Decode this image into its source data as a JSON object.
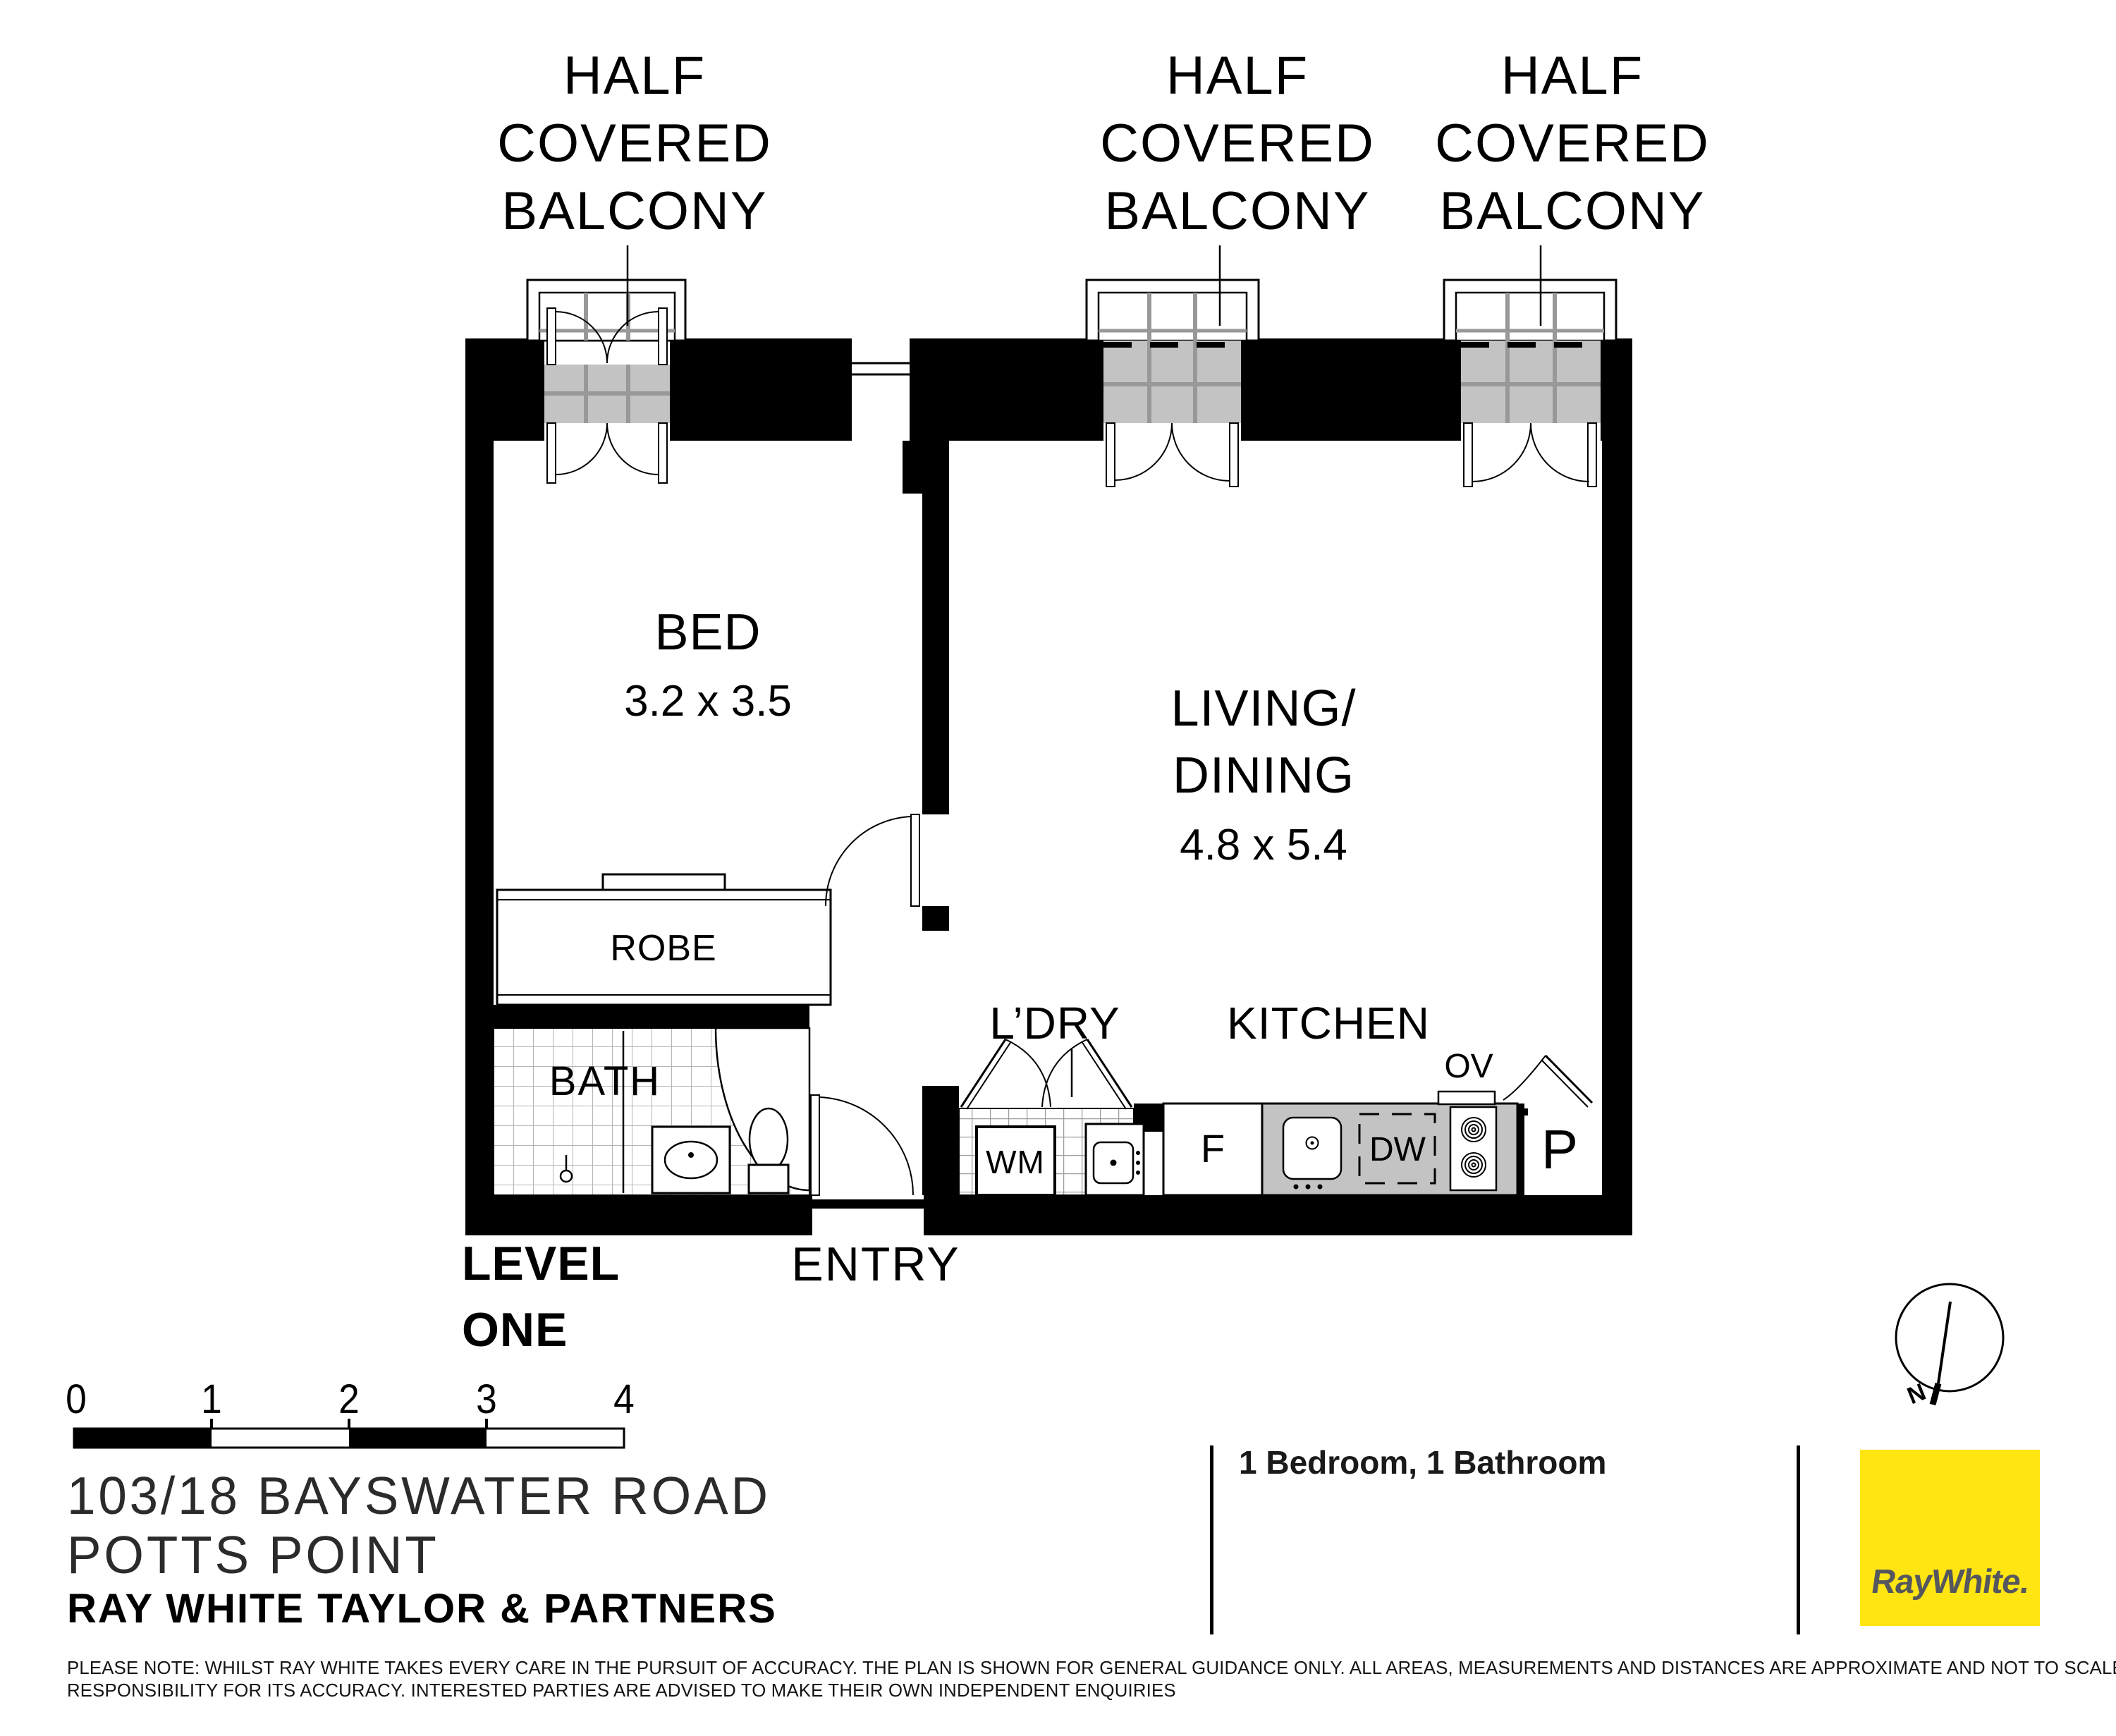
{
  "balcony_labels": [
    {
      "line1": "HALF",
      "line2": "COVERED",
      "line3": "BALCONY"
    },
    {
      "line1": "HALF",
      "line2": "COVERED",
      "line3": "BALCONY"
    },
    {
      "line1": "HALF",
      "line2": "COVERED",
      "line3": "BALCONY"
    }
  ],
  "rooms": {
    "bed": {
      "name": "BED",
      "dims": "3.2 x 3.5"
    },
    "living": {
      "line1": "LIVING/",
      "line2": "DINING",
      "dims": "4.8 x 5.4"
    },
    "robe": {
      "name": "ROBE"
    },
    "bath": {
      "name": "BATH"
    },
    "laundry": {
      "name": "L’DRY"
    },
    "kitchen": {
      "name": "KITCHEN"
    },
    "entry": {
      "name": "ENTRY"
    }
  },
  "appliances": {
    "washing_machine": "WM",
    "fridge": "F",
    "dishwasher": "DW",
    "oven": "OV",
    "pantry": "P"
  },
  "level": {
    "line1": "LEVEL",
    "line2": "ONE"
  },
  "scale_bar": {
    "ticks": [
      "0",
      "1",
      "2",
      "3",
      "4"
    ]
  },
  "compass": {
    "north": "N"
  },
  "footer": {
    "address_line1": "103/18 BAYSWATER ROAD",
    "address_line2": "POTTS POINT",
    "agency": "RAY WHITE TAYLOR & PARTNERS",
    "features": "1 Bedroom, 1 Bathroom",
    "disclaimer_line1": "PLEASE NOTE: WHILST RAY WHITE TAKES EVERY CARE IN THE PURSUIT OF ACCURACY. THE PLAN IS SHOWN FOR GENERAL GUIDANCE ONLY. ALL AREAS, MEASUREMENTS AND DISTANCES ARE APPROXIMATE AND NOT TO SCALE RAY WHITE AND OUR VENDOR WILL ACCEPT NO",
    "disclaimer_line2": "RESPONSIBILITY FOR ITS ACCURACY. INTERESTED PARTIES ARE ADVISED TO MAKE THEIR OWN INDEPENDENT ENQUIRIES"
  },
  "logo": {
    "text": "RayWhite."
  },
  "colors": {
    "wall": "#000000",
    "balcony_shade": "#c3c3c3",
    "shade_grid": "#989898",
    "tile_line": "#b5b5b5",
    "brand_yellow": "#ffe512",
    "logo_text": "#55575e"
  }
}
